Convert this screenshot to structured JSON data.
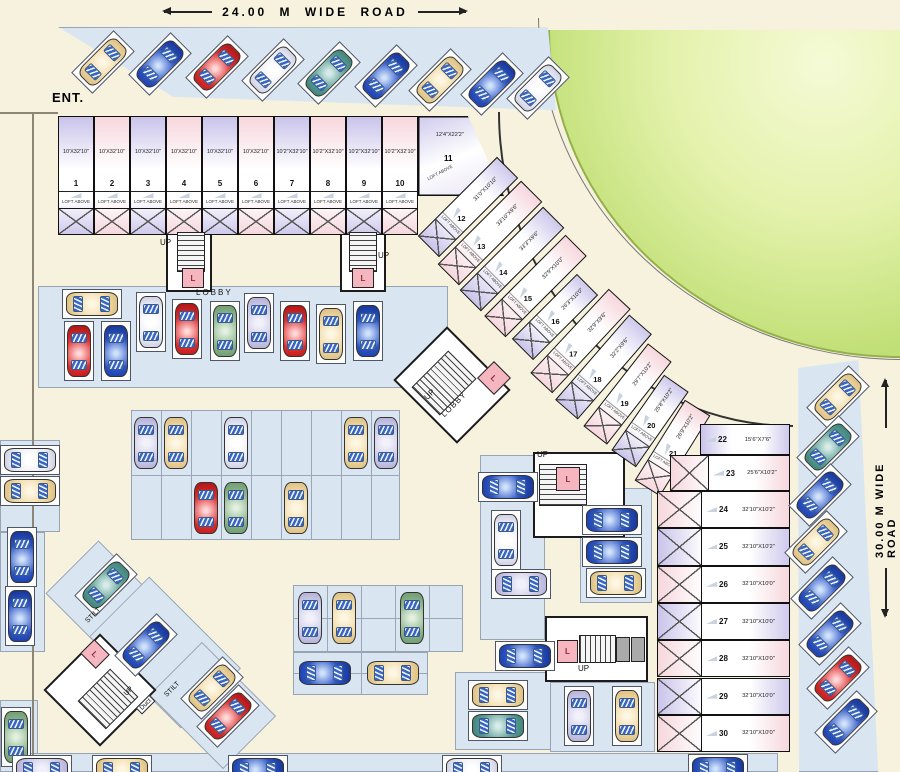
{
  "roads": {
    "top": "24.00 M WIDE ROAD",
    "right": "30.00 M WIDE ROAD"
  },
  "labels": {
    "entrance": "ENT.",
    "lobby": "LOBBY",
    "up": "UP",
    "lift": "L",
    "stilt": "STILT",
    "duct": "Duct",
    "loft": "LOFT ABOVE"
  },
  "colors": {
    "background": "#f7f2dd",
    "parking": "#d9e6f2",
    "unit_lavender": "#c9c3ea",
    "unit_pink": "#f6d7dd",
    "garden": "#c2e078",
    "lift_pink": "#f6b6c0"
  },
  "units_top": [
    {
      "no": "1",
      "dim": "10'X32'10\"",
      "fill": "lav"
    },
    {
      "no": "2",
      "dim": "10'X32'10\"",
      "fill": "pink"
    },
    {
      "no": "3",
      "dim": "10'X32'10\"",
      "fill": "lav"
    },
    {
      "no": "4",
      "dim": "10'X32'10\"",
      "fill": "pink"
    },
    {
      "no": "5",
      "dim": "10'X32'10\"",
      "fill": "lav"
    },
    {
      "no": "6",
      "dim": "10'X32'10\"",
      "fill": "pink"
    },
    {
      "no": "7",
      "dim": "10'2\"X32'10\"",
      "fill": "lav"
    },
    {
      "no": "8",
      "dim": "10'2\"X32'10\"",
      "fill": "pink"
    },
    {
      "no": "9",
      "dim": "10'2\"X32'10\"",
      "fill": "lav"
    },
    {
      "no": "10",
      "dim": "10'2\"X32'10\"",
      "fill": "pink"
    }
  ],
  "units_top_layout": {
    "x0": 58,
    "w": 36,
    "y": 116,
    "h": 119
  },
  "unit11": {
    "no": "11",
    "dim": "12'4\"X22'2\""
  },
  "units_diag": [
    {
      "no": "12",
      "dim": "31'0\"X10'10\"",
      "x": 412,
      "y": 192,
      "len": 112,
      "rot": -45,
      "fill": "lav"
    },
    {
      "no": "13",
      "dim": "33'10\"X9'6\"",
      "x": 431,
      "y": 218,
      "len": 118,
      "rot": -45,
      "fill": "pink"
    },
    {
      "no": "14",
      "dim": "33'3\"X9'6\"",
      "x": 453,
      "y": 244,
      "len": 118,
      "rot": -45,
      "fill": "lav"
    },
    {
      "no": "15",
      "dim": "32'9\"X10'0\"",
      "x": 478,
      "y": 271,
      "len": 115,
      "rot": -45,
      "fill": "pink"
    },
    {
      "no": "16",
      "dim": "26'3\"X10'0\"",
      "x": 509,
      "y": 302,
      "len": 92,
      "rot": -45,
      "fill": "lav"
    },
    {
      "no": "17",
      "dim": "32'9\"X9'6\"",
      "x": 523,
      "y": 326,
      "len": 115,
      "rot": -47,
      "fill": "pink"
    },
    {
      "no": "18",
      "dim": "32'2\"X9'6\"",
      "x": 547,
      "y": 352,
      "len": 113,
      "rot": -49,
      "fill": "lav"
    },
    {
      "no": "19",
      "dim": "29'7\"X10'2\"",
      "x": 575,
      "y": 379,
      "len": 105,
      "rot": -52,
      "fill": "pink"
    },
    {
      "no": "20",
      "dim": "25'8\"X10'2\"",
      "x": 604,
      "y": 406,
      "len": 92,
      "rot": -55,
      "fill": "lav"
    },
    {
      "no": "21",
      "dim": "26'9\"X10'2\"",
      "x": 625,
      "y": 433,
      "len": 95,
      "rot": -58,
      "fill": "pink"
    }
  ],
  "unit22": {
    "no": "22",
    "dim": "15'6\"X7'6\"",
    "x": 700,
    "y": 424,
    "w": 90,
    "h": 31,
    "fill": "lav"
  },
  "unit23": {
    "no": "23",
    "dim": "25'6\"X10'2\"",
    "x": 670,
    "y": 455,
    "w": 120,
    "h": 36,
    "fill": "pink"
  },
  "units_col": [
    {
      "no": "24",
      "dim": "32'10\"X10'2\"",
      "fill": "pink"
    },
    {
      "no": "25",
      "dim": "32'10\"X10'2\"",
      "fill": "lav"
    },
    {
      "no": "26",
      "dim": "32'10\"X10'0\"",
      "fill": "pink"
    },
    {
      "no": "27",
      "dim": "32'10\"X10'0\"",
      "fill": "lav"
    },
    {
      "no": "28",
      "dim": "32'10\"X10'0\"",
      "fill": "pink"
    },
    {
      "no": "29",
      "dim": "32'10\"X10'0\"",
      "fill": "lav"
    },
    {
      "no": "30",
      "dim": "32'10\"X10'0\"",
      "fill": "pink"
    }
  ],
  "units_col_layout": {
    "x": 657,
    "w": 133,
    "y0": 491,
    "rh": 37.3
  },
  "patches": [
    {
      "x": 58,
      "y": 27,
      "w": 500,
      "h": 85,
      "clip": "0% 0%,98% 1%,99.6% 98%,23% 82%"
    },
    {
      "x": 790,
      "y": 358,
      "w": 90,
      "h": 414,
      "clip": "9% 2.4%,76% 0.5%,98% 100%,10% 100%"
    },
    {
      "x": 38,
      "y": 286,
      "w": 410,
      "h": 102
    },
    {
      "x": 131,
      "y": 410,
      "w": 269,
      "h": 130,
      "grid": 30
    },
    {
      "x": 293,
      "y": 585,
      "w": 170,
      "h": 67,
      "grid": 34
    },
    {
      "x": 293,
      "y": 652,
      "w": 135,
      "h": 43,
      "grid": 68
    },
    {
      "x": 0,
      "y": 440,
      "w": 60,
      "h": 92
    },
    {
      "x": 0,
      "y": 532,
      "w": 45,
      "h": 120
    },
    {
      "x": 0,
      "y": 700,
      "w": 38,
      "h": 72
    },
    {
      "x": 0,
      "y": 753,
      "w": 778,
      "h": 19
    },
    {
      "x": 480,
      "y": 455,
      "w": 65,
      "h": 185
    },
    {
      "x": 455,
      "y": 672,
      "w": 105,
      "h": 78
    },
    {
      "x": 580,
      "y": 488,
      "w": 72,
      "h": 115
    },
    {
      "x": 550,
      "y": 682,
      "w": 105,
      "h": 70
    },
    {
      "x": 58,
      "y": 563,
      "w": 95,
      "h": 75,
      "rot": 45
    },
    {
      "x": 100,
      "y": 610,
      "w": 130,
      "h": 85,
      "rot": 45
    },
    {
      "x": 160,
      "y": 668,
      "w": 105,
      "h": 75,
      "rot": 45
    }
  ],
  "lines": [
    {
      "x": 0,
      "y": 112,
      "w": 58,
      "h": 2
    },
    {
      "x": 32,
      "y": 112,
      "w": 2,
      "h": 660
    }
  ],
  "rooms": [
    {
      "x": 166,
      "y": 230,
      "w": 46,
      "h": 62
    },
    {
      "x": 340,
      "y": 230,
      "w": 46,
      "h": 62
    },
    {
      "x": 407,
      "y": 347,
      "w": 90,
      "h": 76,
      "rot": 45
    },
    {
      "x": 533,
      "y": 452,
      "w": 92,
      "h": 86
    },
    {
      "x": 545,
      "y": 616,
      "w": 103,
      "h": 66
    },
    {
      "x": 60,
      "y": 650,
      "w": 80,
      "h": 80,
      "rot": 45
    }
  ],
  "stairs": [
    {
      "x": 177,
      "y": 232,
      "w": 28,
      "h": 40
    },
    {
      "x": 349,
      "y": 232,
      "w": 28,
      "h": 40
    },
    {
      "x": 424,
      "y": 357,
      "w": 40,
      "h": 52,
      "rot": 45
    },
    {
      "x": 539,
      "y": 464,
      "w": 48,
      "h": 42
    },
    {
      "x": 579,
      "y": 635,
      "w": 37,
      "h": 28,
      "dir": 90
    },
    {
      "x": 88,
      "y": 676,
      "w": 40,
      "h": 46,
      "rot": 45
    }
  ],
  "lifts": [
    {
      "x": 182,
      "y": 268,
      "w": 22,
      "h": 20
    },
    {
      "x": 352,
      "y": 268,
      "w": 22,
      "h": 20
    },
    {
      "x": 482,
      "y": 366,
      "w": 24,
      "h": 24,
      "rot": 45
    },
    {
      "x": 556,
      "y": 467,
      "w": 24,
      "h": 24
    },
    {
      "x": 557,
      "y": 640,
      "w": 21,
      "h": 23
    },
    {
      "x": 84,
      "y": 644,
      "w": 22,
      "h": 20,
      "rot": 45
    }
  ],
  "ducts": [
    {
      "x": 616,
      "y": 637,
      "w": 14,
      "h": 25
    },
    {
      "x": 631,
      "y": 637,
      "w": 14,
      "h": 25
    }
  ],
  "misc_labels": [
    {
      "t": "LOBBY",
      "x": 196,
      "y": 288,
      "fs": 8,
      "ls": 2
    },
    {
      "t": "UP",
      "x": 160,
      "y": 238,
      "fs": 8
    },
    {
      "t": "UP",
      "x": 378,
      "y": 251,
      "fs": 8
    },
    {
      "t": "UP",
      "x": 424,
      "y": 390,
      "fs": 8,
      "rot": -45
    },
    {
      "t": "LOBBY",
      "x": 438,
      "y": 400,
      "fs": 8,
      "rot": -45,
      "ls": 1
    },
    {
      "t": "UP",
      "x": 537,
      "y": 450,
      "fs": 8
    },
    {
      "t": "UP",
      "x": 578,
      "y": 664,
      "fs": 8
    },
    {
      "t": "STILT",
      "x": 84,
      "y": 612,
      "fs": 7,
      "rot": -45
    },
    {
      "t": "STILT",
      "x": 163,
      "y": 686,
      "fs": 7,
      "rot": -45
    },
    {
      "t": "UP",
      "x": 124,
      "y": 688,
      "fs": 7,
      "rot": -45
    },
    {
      "t": "Duct",
      "x": 136,
      "y": 700,
      "fs": 6.5,
      "rot": -45,
      "box": true
    }
  ],
  "cars": [
    {
      "x": 103,
      "y": 62,
      "r": 45,
      "c": "cream",
      "f": 1
    },
    {
      "x": 160,
      "y": 64,
      "r": 45,
      "c": "blue",
      "f": 1
    },
    {
      "x": 217,
      "y": 67,
      "r": 45,
      "c": "red",
      "f": 1
    },
    {
      "x": 273,
      "y": 70,
      "r": 45,
      "c": "white",
      "f": 1
    },
    {
      "x": 329,
      "y": 73,
      "r": 45,
      "c": "teal",
      "f": 1
    },
    {
      "x": 386,
      "y": 76,
      "r": 45,
      "c": "blue",
      "f": 1
    },
    {
      "x": 440,
      "y": 80,
      "r": 45,
      "c": "cream",
      "f": 1
    },
    {
      "x": 492,
      "y": 84,
      "r": 45,
      "c": "blue",
      "f": 1
    },
    {
      "x": 538,
      "y": 88,
      "r": 45,
      "c": "white",
      "f": 1
    },
    {
      "x": 92,
      "y": 304,
      "r": 90,
      "c": "cream",
      "f": 1
    },
    {
      "x": 79,
      "y": 351,
      "r": 0,
      "c": "red",
      "f": 1
    },
    {
      "x": 116,
      "y": 351,
      "r": 0,
      "c": "blue",
      "f": 1
    },
    {
      "x": 151,
      "y": 322,
      "r": 0,
      "c": "white",
      "f": 1
    },
    {
      "x": 187,
      "y": 329,
      "r": 0,
      "c": "red",
      "f": 1
    },
    {
      "x": 225,
      "y": 331,
      "r": 0,
      "c": "green",
      "f": 1
    },
    {
      "x": 259,
      "y": 323,
      "r": 0,
      "c": "lav",
      "f": 1
    },
    {
      "x": 295,
      "y": 331,
      "r": 0,
      "c": "red",
      "f": 1
    },
    {
      "x": 331,
      "y": 334,
      "r": 0,
      "c": "cream",
      "f": 1
    },
    {
      "x": 368,
      "y": 331,
      "r": 0,
      "c": "blue",
      "f": 1
    },
    {
      "x": 146,
      "y": 443,
      "r": 0,
      "c": "lav",
      "f": 0
    },
    {
      "x": 176,
      "y": 443,
      "r": 0,
      "c": "cream",
      "f": 0
    },
    {
      "x": 236,
      "y": 443,
      "r": 0,
      "c": "white",
      "f": 0
    },
    {
      "x": 356,
      "y": 443,
      "r": 0,
      "c": "cream",
      "f": 0
    },
    {
      "x": 386,
      "y": 443,
      "r": 0,
      "c": "lav",
      "f": 0
    },
    {
      "x": 206,
      "y": 508,
      "r": 0,
      "c": "red",
      "f": 0
    },
    {
      "x": 236,
      "y": 508,
      "r": 0,
      "c": "green",
      "f": 0
    },
    {
      "x": 296,
      "y": 508,
      "r": 0,
      "c": "cream",
      "f": 0
    },
    {
      "x": 310,
      "y": 618,
      "r": 0,
      "c": "lav",
      "f": 0
    },
    {
      "x": 344,
      "y": 618,
      "r": 0,
      "c": "cream",
      "f": 0
    },
    {
      "x": 412,
      "y": 618,
      "r": 0,
      "c": "green",
      "f": 0
    },
    {
      "x": 325,
      "y": 673,
      "r": 90,
      "c": "blue",
      "f": 0
    },
    {
      "x": 393,
      "y": 673,
      "r": 90,
      "c": "cream",
      "f": 0
    },
    {
      "x": 508,
      "y": 487,
      "r": 90,
      "c": "blue",
      "f": 1
    },
    {
      "x": 506,
      "y": 540,
      "r": 0,
      "c": "white",
      "f": 1
    },
    {
      "x": 521,
      "y": 584,
      "r": 90,
      "c": "lav",
      "f": 1
    },
    {
      "x": 525,
      "y": 656,
      "r": 90,
      "c": "blue",
      "f": 1
    },
    {
      "x": 498,
      "y": 695,
      "r": 90,
      "c": "cream",
      "f": 1
    },
    {
      "x": 498,
      "y": 726,
      "r": 90,
      "c": "teal",
      "f": 1
    },
    {
      "x": 612,
      "y": 520,
      "r": 90,
      "c": "blue",
      "f": 1
    },
    {
      "x": 612,
      "y": 552,
      "r": 90,
      "c": "blue",
      "f": 1
    },
    {
      "x": 616,
      "y": 583,
      "r": 90,
      "c": "cream",
      "f": 1
    },
    {
      "x": 579,
      "y": 716,
      "r": 0,
      "c": "lav",
      "f": 1
    },
    {
      "x": 627,
      "y": 716,
      "r": 0,
      "c": "cream",
      "f": 1
    },
    {
      "x": 30,
      "y": 460,
      "r": 90,
      "c": "white",
      "f": 1
    },
    {
      "x": 30,
      "y": 491,
      "r": 90,
      "c": "cream",
      "f": 1
    },
    {
      "x": 22,
      "y": 557,
      "r": 0,
      "c": "blue",
      "f": 1
    },
    {
      "x": 20,
      "y": 616,
      "r": 0,
      "c": "blue",
      "f": 1
    },
    {
      "x": 16,
      "y": 737,
      "r": 0,
      "c": "green",
      "f": 1
    },
    {
      "x": 42,
      "y": 770,
      "r": 90,
      "c": "lav",
      "f": 1
    },
    {
      "x": 122,
      "y": 770,
      "r": 90,
      "c": "cream",
      "f": 1
    },
    {
      "x": 258,
      "y": 770,
      "r": 90,
      "c": "blue",
      "f": 1
    },
    {
      "x": 472,
      "y": 770,
      "r": 90,
      "c": "white",
      "f": 1
    },
    {
      "x": 718,
      "y": 769,
      "r": 90,
      "c": "blue",
      "f": 1
    },
    {
      "x": 106,
      "y": 585,
      "r": 45,
      "c": "teal",
      "f": 1
    },
    {
      "x": 146,
      "y": 645,
      "r": 45,
      "c": "blue",
      "f": 1
    },
    {
      "x": 212,
      "y": 688,
      "r": 45,
      "c": "cream",
      "f": 1
    },
    {
      "x": 228,
      "y": 716,
      "r": 45,
      "c": "red",
      "f": 1
    },
    {
      "x": 838,
      "y": 397,
      "r": 45,
      "c": "cream",
      "f": 1
    },
    {
      "x": 828,
      "y": 447,
      "r": 45,
      "c": "teal",
      "f": 1
    },
    {
      "x": 820,
      "y": 495,
      "r": 45,
      "c": "blue",
      "f": 1
    },
    {
      "x": 816,
      "y": 542,
      "r": 45,
      "c": "cream",
      "f": 1
    },
    {
      "x": 822,
      "y": 588,
      "r": 45,
      "c": "blue",
      "f": 1
    },
    {
      "x": 830,
      "y": 634,
      "r": 45,
      "c": "blue",
      "f": 1
    },
    {
      "x": 838,
      "y": 678,
      "r": 45,
      "c": "red",
      "f": 1
    },
    {
      "x": 846,
      "y": 722,
      "r": 45,
      "c": "blue",
      "f": 1
    }
  ]
}
